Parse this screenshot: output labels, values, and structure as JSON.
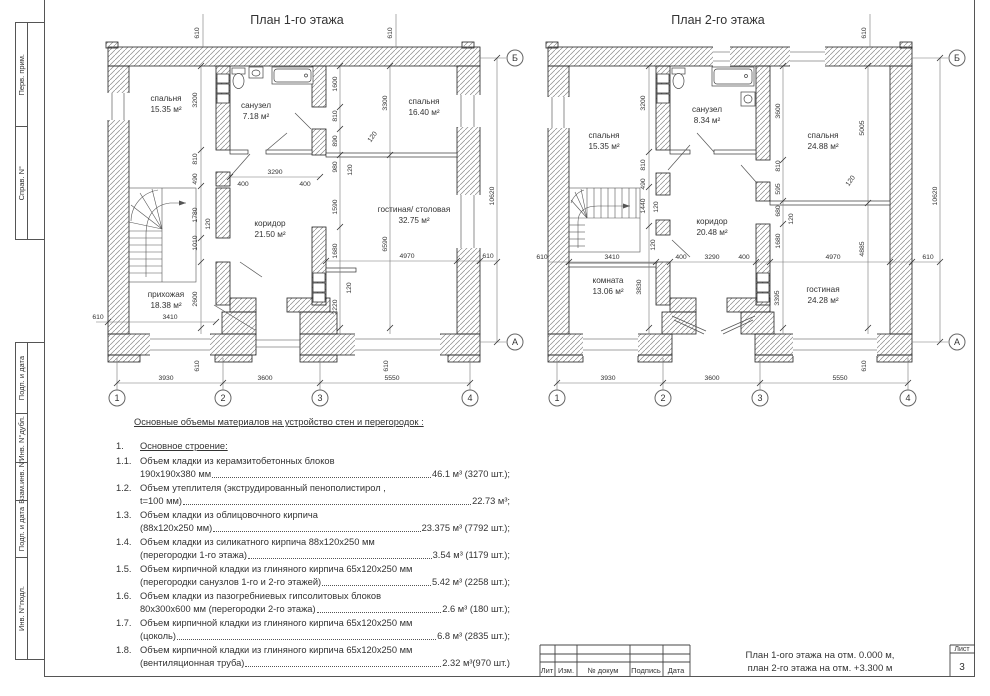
{
  "sheet": {
    "margin_labels": [
      "Перв. прим.",
      "Справ. N°",
      "Подп. и дата",
      "Инв. N°дубл.",
      "Взам.инв. N°",
      "Подп. и дата",
      "Инв. N°подл."
    ]
  },
  "axes": {
    "c1": "1",
    "c2": "2",
    "c3": "3",
    "c4": "4",
    "top": "Б",
    "bottom": "А"
  },
  "dims": {
    "v610": "610",
    "v3200": "3200",
    "v810": "810",
    "v490": "490",
    "v1780": "1780",
    "v120": "120",
    "v1010": "1010",
    "v2600": "2600",
    "v3410": "3410",
    "v3290": "3290",
    "v400": "400",
    "v1600": "1600",
    "v890": "890",
    "v980": "980",
    "v1590": "1590",
    "v3300": "3300",
    "v1680": "1680",
    "v2220": "2220",
    "v6590": "6590",
    "v4970": "4970",
    "v10620": "10620",
    "v3930": "3930",
    "v3600": "3600",
    "v5550": "5550",
    "v1440": "1440",
    "v595": "595",
    "v680": "680",
    "v3830": "3830",
    "v3395": "3395",
    "v5005": "5005",
    "v4885": "4885"
  },
  "plan1": {
    "title": "План 1-го этажа",
    "rooms": {
      "bedroom1": {
        "name": "спальня",
        "area": "15.35 м²"
      },
      "wc": {
        "name": "санузел",
        "area": "7.18 м²"
      },
      "bedroom2": {
        "name": "спальня",
        "area": "16.40 м²"
      },
      "corridor": {
        "name": "коридор",
        "area": "21.50 м²"
      },
      "hall": {
        "name": "прихожая",
        "area": "18.38 м²"
      },
      "living": {
        "name": "гостиная/ столовая",
        "area": "32.75 м²"
      }
    }
  },
  "plan2": {
    "title": "План 2-го этажа",
    "rooms": {
      "bedroom1": {
        "name": "спальня",
        "area": "15.35 м²"
      },
      "wc": {
        "name": "санузел",
        "area": "8.34 м²"
      },
      "bedroom2": {
        "name": "спальня",
        "area": "24.88 м²"
      },
      "corridor": {
        "name": "коридор",
        "area": "20.48 м²"
      },
      "room": {
        "name": "комната",
        "area": "13.06 м²"
      },
      "living": {
        "name": "гостиная",
        "area": "24.28 м²"
      }
    }
  },
  "materials": {
    "title": "Основные объемы материалов на устройство стен и перегородок :",
    "section_num": "1.",
    "section_title": "Основное строение:",
    "items": [
      {
        "num": "1.1.",
        "line1": "Объем кладки из керамзитобетонных блоков",
        "line2": "190х190х380 мм",
        "value": "46.1 м³ (3270 шт.);"
      },
      {
        "num": "1.2.",
        "line1": "Объем утеплителя (экструдированный пенополистирол ,",
        "line2": "t=100 мм)",
        "value": "22.73 м³;"
      },
      {
        "num": "1.3.",
        "line1": "Объем кладки из облицовочного кирпича",
        "line2": "(88х120х250 мм)",
        "value": "23.375 м³ (7792 шт.);"
      },
      {
        "num": "1.4.",
        "line1": "Объем кладки из силикатного кирпича 88х120х250 мм",
        "line2": "(перегородки 1-го этажа)",
        "value": "3.54 м³ (1179 шт.);"
      },
      {
        "num": "1.5.",
        "line1": "Объем кирпичной кладки из глиняного кирпича 65х120х250 мм",
        "line2": "(перегородки санузлов 1-го и 2-го этажей)",
        "value": "5.42 м³ (2258 шт.);"
      },
      {
        "num": "1.6.",
        "line1": "Объем кладки из пазогребниевых гипсолитовых блоков",
        "line2": "80х300х600 мм (перегородки 2-го этажа)",
        "value": "2.6 м³ (180 шт.);"
      },
      {
        "num": "1.7.",
        "line1": "Объем кирпичной кладки из глиняного кирпича 65х120х250 мм",
        "line2": "(цоколь)",
        "value": "6.8 м³ (2835 шт.);"
      },
      {
        "num": "1.8.",
        "line1": "Объем кирпичной кладки из глиняного кирпича 65х120х250 мм",
        "line2": "(вентиляционная труба)",
        "value": "2.32 м³(970 шт.)"
      }
    ]
  },
  "stamp": {
    "cols": [
      "Лит",
      "Изм.",
      "№ докум",
      "Подпись",
      "Дата"
    ],
    "title_line1": "План 1-ого этажа на отм. 0.000 м,",
    "title_line2": "план 2-го этажа на отм. +3.300 м",
    "sheet_label": "Лист",
    "sheet_number": "3"
  }
}
